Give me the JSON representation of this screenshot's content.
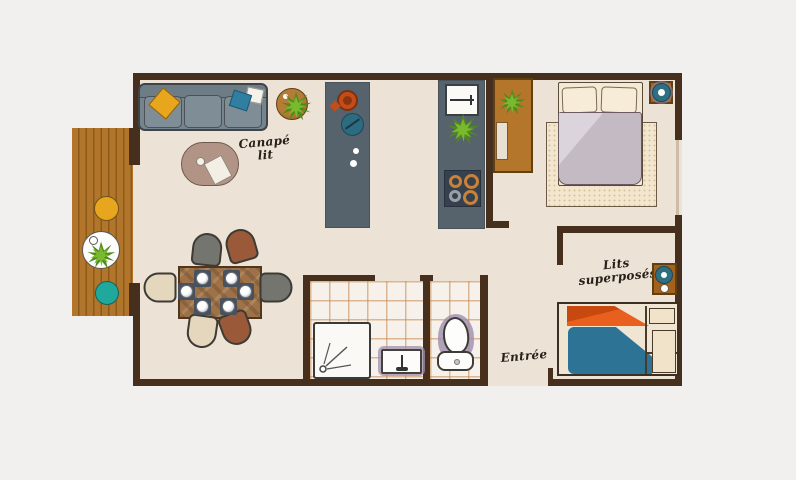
{
  "labels": {
    "sofa_bed": {
      "line1": "Canapé",
      "line2": "lit"
    },
    "entrance": "Entrée",
    "bunk_beds": {
      "line1": "Lits",
      "line2": "superposés"
    }
  },
  "palette": {
    "background": "#f1f0ee",
    "floor": "#ece2d5",
    "wall": "#46301d",
    "deck_wood": "#b1752b",
    "kitchen_counter": "#57636c",
    "cabinet_wood": "#b3762b",
    "sofa_gray": "#76848e",
    "accent_yellow": "#e8a61e",
    "accent_teal": "#1fa89b",
    "bunk_orange": "#e0561c",
    "bunk_blue": "#2c7396",
    "tile_grout": "#c7854a",
    "fixture_shadow_purple": "#9d8fae"
  },
  "furniture": [
    "sofa-bed",
    "coffee-table",
    "side-table-with-plant",
    "kitchen-island",
    "kitchen-counter-with-sink-and-stove",
    "wardrobe",
    "double-bed",
    "bedroom-rug",
    "nightstand",
    "dining-table-six-chairs",
    "shower",
    "washbasin",
    "toilet",
    "bunk-bed",
    "terrace-deck",
    "terrace-table",
    "terrace-stools"
  ]
}
